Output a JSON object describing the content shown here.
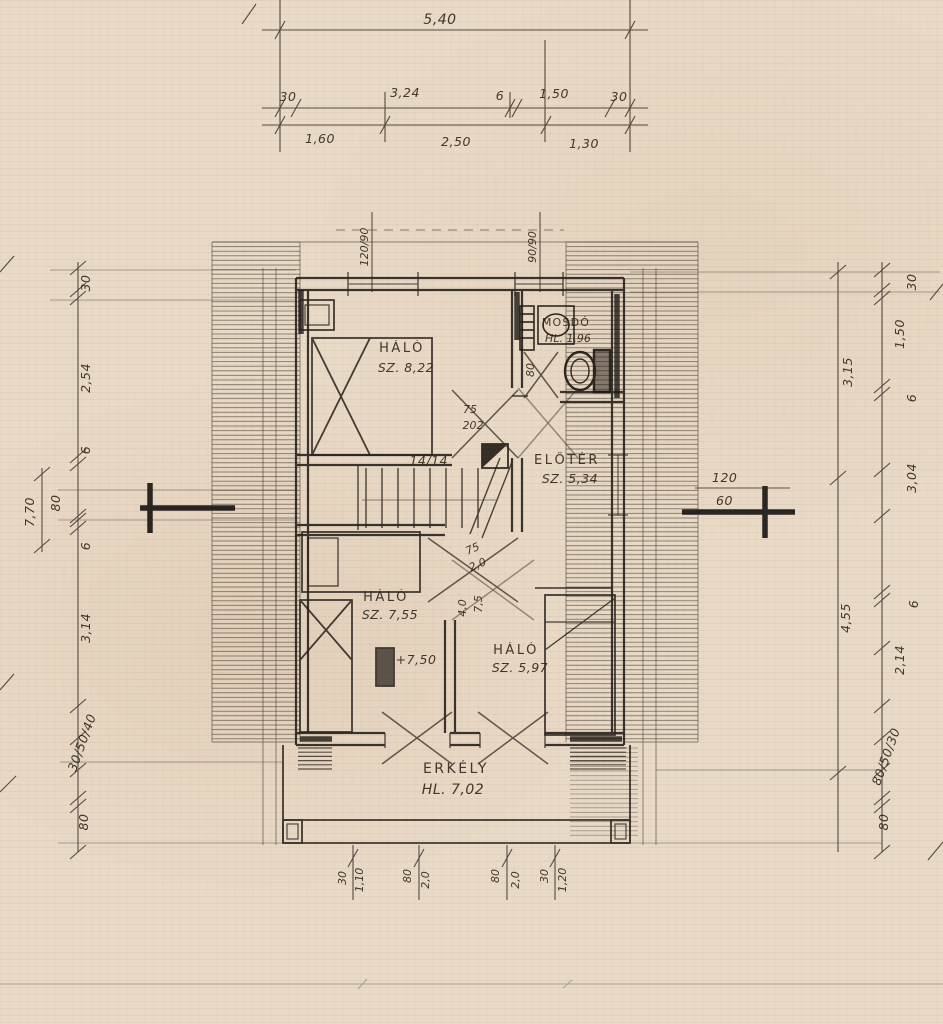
{
  "top_dims": {
    "overall": "5,40",
    "row2": [
      "30",
      "3,24",
      "6",
      "1,50",
      "30"
    ],
    "row3": [
      "1,60",
      "2,50",
      "1,30"
    ]
  },
  "window_tags": {
    "left": "120/90",
    "right": "90/90"
  },
  "rooms": {
    "bedroom_top": {
      "name": "HÁLÓ",
      "area": "SZ. 8,22"
    },
    "washroom": {
      "name": "MOSDÓ",
      "area": "HL. 1,96"
    },
    "foyer": {
      "name": "ELŐTÉR",
      "area": "SZ. 5,34"
    },
    "bedroom_mid": {
      "name": "HÁLÓ",
      "area": "SZ. 7,55"
    },
    "bedroom_right": {
      "name": "HÁLÓ",
      "area": "SZ. 5,97"
    },
    "balcony": {
      "name": "ERKÉLY",
      "area": "HL. 7,02"
    }
  },
  "annotations": {
    "chimney": "14/14",
    "door_top": [
      "75",
      "202"
    ],
    "door_mid": [
      "75",
      "2,0"
    ],
    "door_low": [
      "4,0",
      "7,5"
    ],
    "level": "+7,50",
    "wc_width": "80",
    "window_right": [
      "120",
      "60"
    ]
  },
  "dims_left": {
    "chain": [
      "30",
      "2,54",
      "6",
      "80",
      "6",
      "3,14"
    ],
    "overall": "7,70",
    "stack": "30/50/40",
    "bottom": "80"
  },
  "dims_right": {
    "chain": [
      "30",
      "1,50",
      "6",
      "3,04",
      "6",
      "2,14"
    ],
    "inner_top": "3,15",
    "inner_bottom": "4,55",
    "stack": "80/50/30",
    "bottom": "80"
  },
  "dims_bottom": [
    {
      "a": "30",
      "b": "1,10"
    },
    {
      "a": "80",
      "b": "2,0"
    },
    {
      "a": "80",
      "b": "2,0"
    },
    {
      "a": "30",
      "b": "1,20"
    }
  ]
}
